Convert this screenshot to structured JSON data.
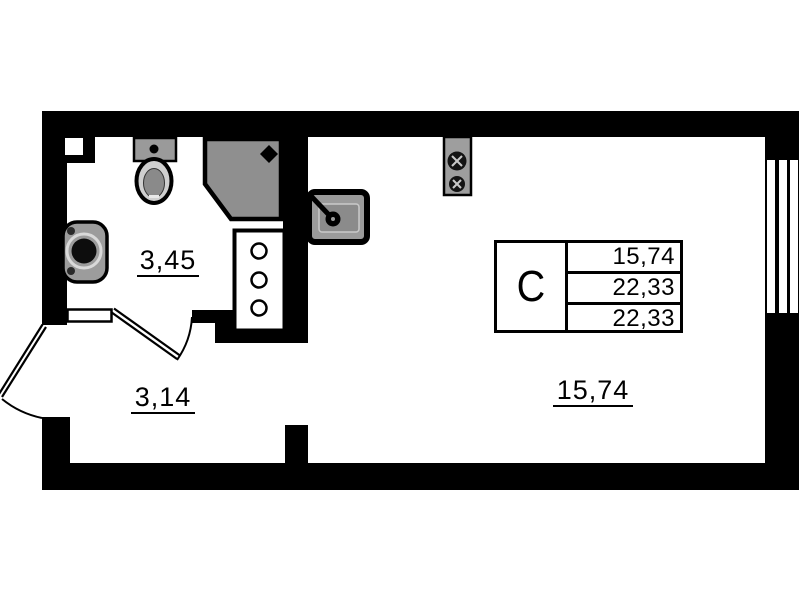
{
  "plan": {
    "legend": {
      "unit_type": "С",
      "rows": [
        "15,74",
        "22,33",
        "22,33"
      ]
    },
    "rooms": [
      {
        "id": "bathroom",
        "area_label": "3,45"
      },
      {
        "id": "hallway",
        "area_label": "3,14"
      },
      {
        "id": "living-kitchen",
        "area_label": "15,74"
      }
    ],
    "fixtures": [
      "toilet",
      "shower",
      "washbasin",
      "kitchen-sink",
      "stove",
      "plumbing-shaft"
    ],
    "openings": [
      "entrance-door",
      "bathroom-door",
      "window"
    ],
    "colors": {
      "wall": "#000000",
      "floor": "#ffffff",
      "fixture_gray": "#8f8f8f"
    }
  }
}
